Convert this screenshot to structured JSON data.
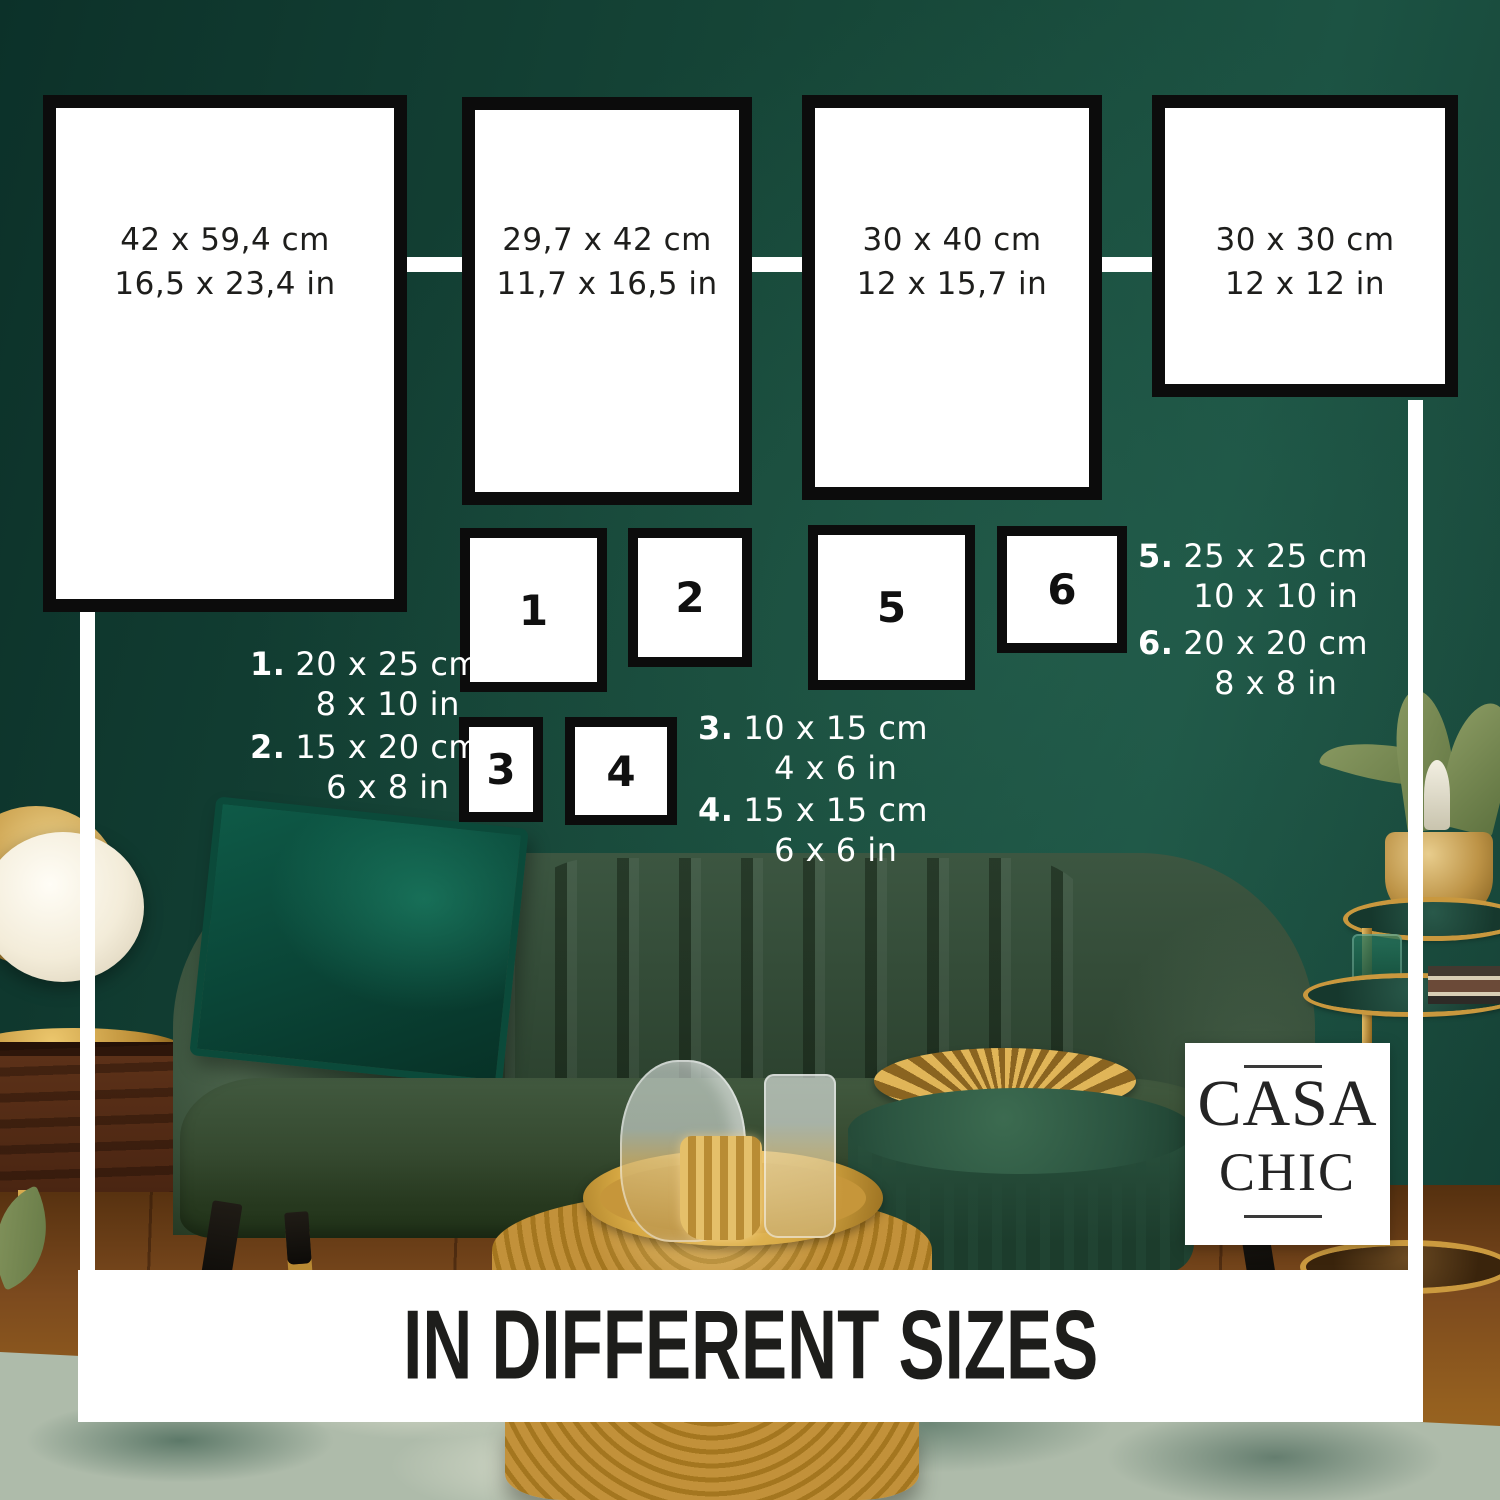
{
  "banner": {
    "title": "IN DIFFERENT SIZES"
  },
  "logo": {
    "line1": "CASA",
    "line2": "CHIC"
  },
  "frames_large": [
    {
      "cm": "42 x 59,4 cm",
      "inch": "16,5 x 23,4 in"
    },
    {
      "cm": "29,7 x 42 cm",
      "inch": "11,7 x 16,5 in"
    },
    {
      "cm": "30 x 40 cm",
      "inch": "12 x 15,7 in"
    },
    {
      "cm": "30 x 30 cm",
      "inch": "12 x 12 in"
    }
  ],
  "frames_numbered": [
    {
      "label": "1"
    },
    {
      "label": "2"
    },
    {
      "label": "3"
    },
    {
      "label": "4"
    },
    {
      "label": "5"
    },
    {
      "label": "6"
    }
  ],
  "legend": [
    {
      "num": "1.",
      "cm": "20 x 25 cm",
      "inch": "8 x 10 in"
    },
    {
      "num": "2.",
      "cm": "15 x 20 cm",
      "inch": "6 x 8 in"
    },
    {
      "num": "3.",
      "cm": "10 x 15 cm",
      "inch": "4 x 6 in"
    },
    {
      "num": "4.",
      "cm": "15 x 15 cm",
      "inch": "6 x 6 in"
    },
    {
      "num": "5.",
      "cm": "25 x 25 cm",
      "inch": "10 x 10 in"
    },
    {
      "num": "6.",
      "cm": "20 x 20 cm",
      "inch": "8 x 8 in"
    }
  ],
  "colors": {
    "wall_green": "#16493b",
    "frame_border": "#0c0c0c",
    "accent_gold": "#c2913a",
    "text_dark": "#1d1d1b",
    "text_light": "#ffffff"
  }
}
